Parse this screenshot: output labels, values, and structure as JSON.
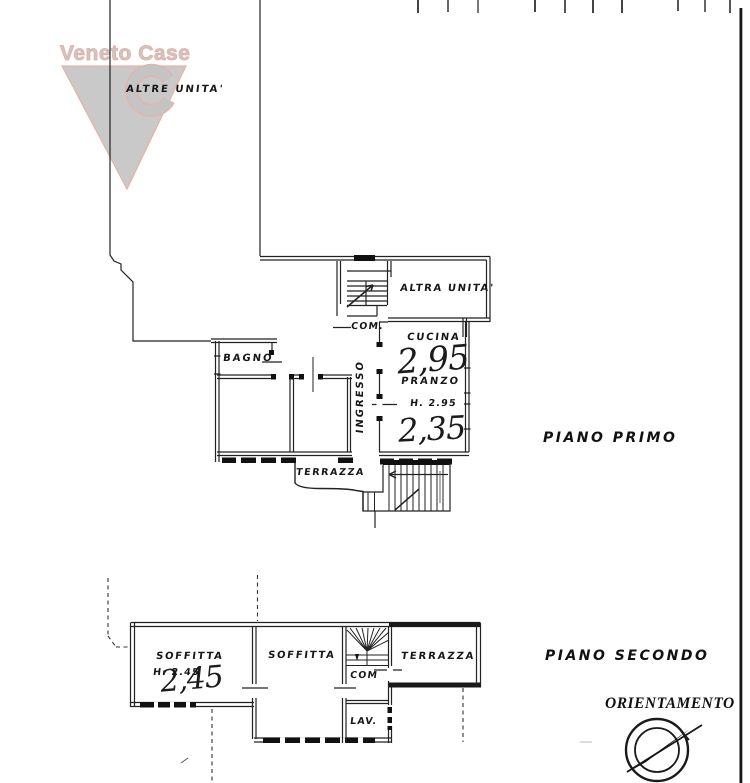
{
  "watermark": {
    "brand": "Veneto Case"
  },
  "plans": {
    "first_floor": {
      "title": "PIANO PRIMO",
      "other_unit_top_label": "ALTRE UNITA'",
      "rooms": {
        "altra_unita": "ALTRA UNITA'",
        "com": "COM.",
        "cucina": "CUCINA",
        "pranzo": "PRANZO",
        "pranzo_height": "H. 2.95",
        "bagno": "BAGNO",
        "ingresso": "INGRESSO",
        "terrazza": "TERRAZZA"
      },
      "handwritten": {
        "cucina_height": "2,95",
        "pranzo_height": "2,35"
      }
    },
    "second_floor": {
      "title": "PIANO SECONDO",
      "rooms": {
        "soffitta_left": "SOFFITTA",
        "soffitta_left_height": "H. 2.45",
        "soffitta_middle": "SOFFITTA",
        "com": "COM",
        "terrazza": "TERRAZZA",
        "lav": "LAV."
      },
      "handwritten": {
        "soffitta_height": "2,45"
      }
    }
  },
  "orientation": {
    "label": "ORIENTAMENTO"
  }
}
